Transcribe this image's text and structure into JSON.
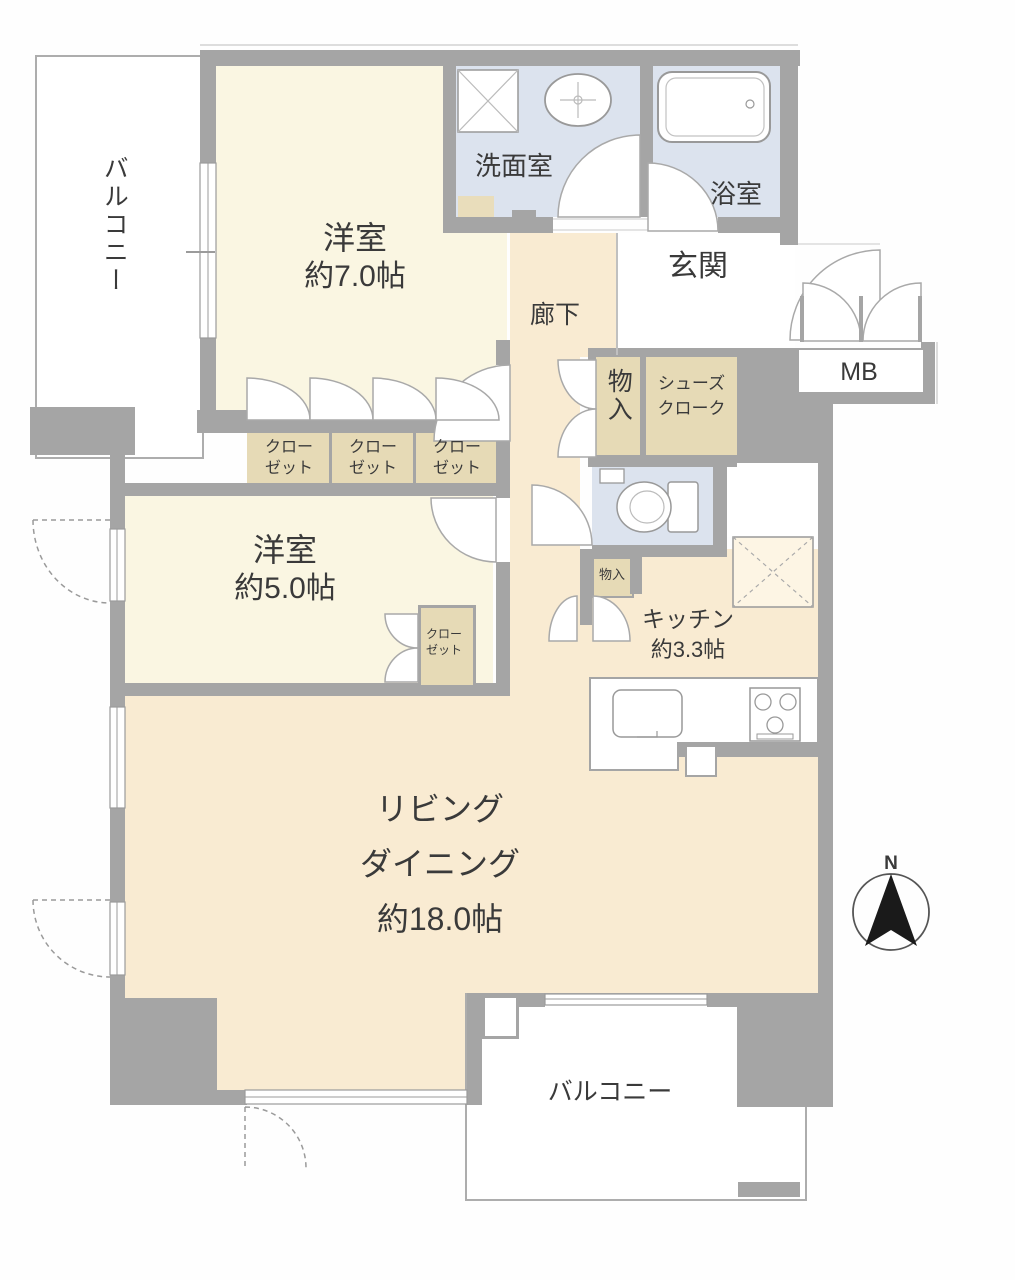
{
  "plan_title": "apartment-floor-plan",
  "rooms": {
    "balcony_top": {
      "label": "バルコニー"
    },
    "bedroom_7": {
      "label": "洋室",
      "size": "約7.0帖"
    },
    "washroom": {
      "label": "洗面室"
    },
    "bathroom": {
      "label": "浴室"
    },
    "entrance": {
      "label": "玄関"
    },
    "meter_box": {
      "label": "MB"
    },
    "corridor": {
      "label": "廊下"
    },
    "storage": {
      "label": "物入"
    },
    "shoe_closet": {
      "line1": "シューズ",
      "line2": "クローク"
    },
    "closets": [
      {
        "line1": "クロー",
        "line2": "ゼット"
      },
      {
        "line1": "クロー",
        "line2": "ゼット"
      },
      {
        "line1": "クロー",
        "line2": "ゼット"
      }
    ],
    "bedroom_5": {
      "label": "洋室",
      "size": "約5.0帖"
    },
    "closet_small": {
      "line1": "クロー",
      "line2": "ゼット"
    },
    "storage_small": {
      "label": "物入"
    },
    "kitchen": {
      "label": "キッチン",
      "size": "約3.3帖"
    },
    "living_dining": {
      "line1": "リビング",
      "line2": "ダイニング",
      "line3": "約18.0帖"
    },
    "balcony_bottom": {
      "label": "バルコニー"
    }
  },
  "compass": {
    "north_label": "N"
  },
  "icons": [
    "washing-machine-pan",
    "wash-basin",
    "bathtub",
    "toilet",
    "refrigerator",
    "kitchen-sink",
    "stove",
    "north-arrow"
  ],
  "colors": {
    "wall": "#a5a5a5",
    "room_cream": "#faf6e2",
    "room_peach": "#f9ebd2",
    "wet_blue": "#dce3ee",
    "closet_tan": "#e6dab6",
    "white": "#ffffff",
    "text": "#3a3a3a"
  }
}
